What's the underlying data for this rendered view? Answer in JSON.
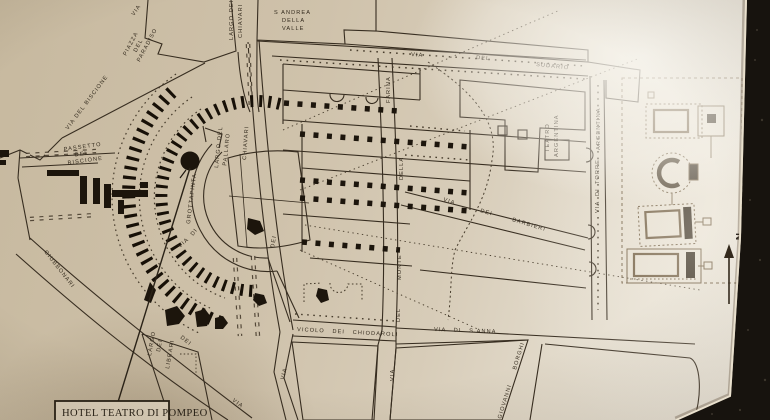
{
  "photo": {
    "hotel_callout": "HOTEL TEATRO DI POMPEO",
    "compass": "N"
  },
  "landmarks": {
    "s_andrea": [
      "S ANDREA",
      "DELLA",
      "VALLE"
    ],
    "teatro_argentina": [
      "TEATRO",
      "ARGENTINA"
    ],
    "piazza_paradiso": [
      "PIAZZA",
      "DEL",
      "PARADISO"
    ],
    "largo_chiavari": [
      "LARGO DEI",
      "CHIAVARI"
    ],
    "largo_pallaro": [
      "LARGO DEL",
      "PALLARO"
    ],
    "largo_librari": [
      "LARGO",
      "DEI",
      "LIBRARI"
    ],
    "passetto_biscione": [
      "PASSETTO",
      "DEL",
      "BISCIONE"
    ]
  },
  "streets": {
    "via_top": "VIA",
    "biscione": "VIA DEL BISCIONE",
    "giubbonari": [
      "VIA",
      "DEI",
      "GIUBBONARI"
    ],
    "grottapinta": [
      "VIA",
      "DI",
      "GROTTAPINTA"
    ],
    "chiavari": [
      "VIA",
      "DEI",
      "CHIAVARI"
    ],
    "monte_farina": [
      "VIA",
      "DEL",
      "MONTE",
      "DELLA",
      "FARINA"
    ],
    "sudario": [
      "VIA",
      "DEL",
      "SUDARIO"
    ],
    "barbieri": [
      "VIA",
      "DEI",
      "BARBIERI"
    ],
    "torre_argentina": [
      "VIA",
      "DI",
      "TORRE",
      "ARGENTINA"
    ],
    "chiodaroli": "VICOLO DEI CHIODAROLI",
    "s_anna": "VIA DI S.ANNA",
    "giovanni_borghi": [
      "GIOVANNI",
      "BORGHI"
    ]
  }
}
